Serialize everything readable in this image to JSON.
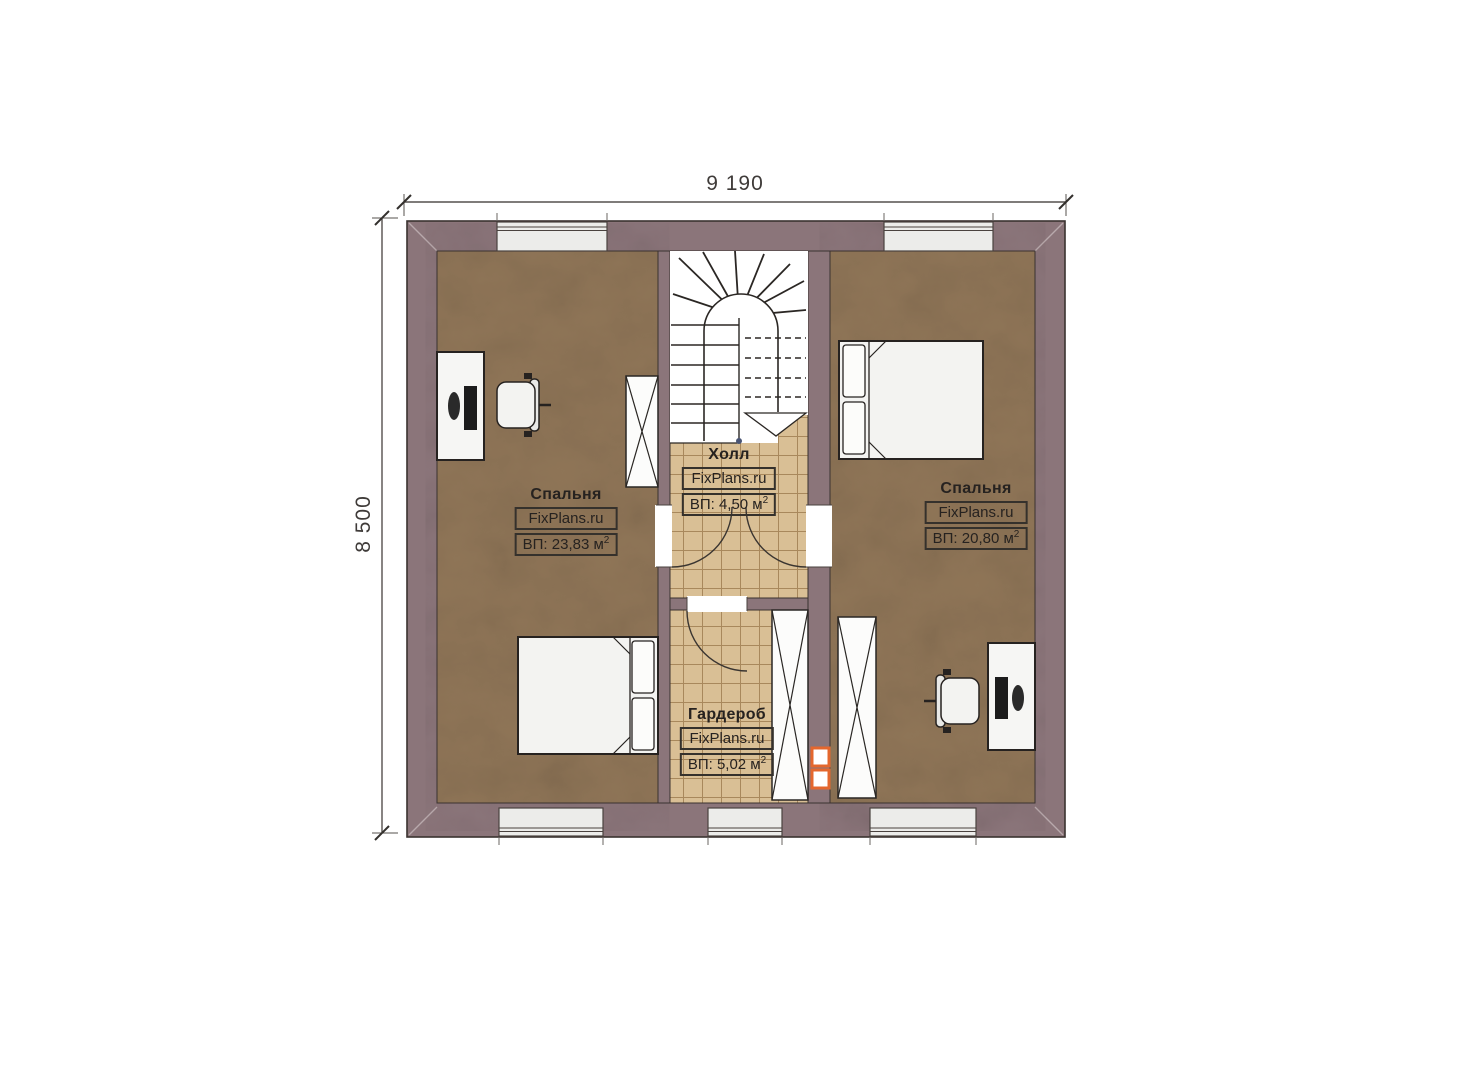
{
  "plan": {
    "width_dim": "9 190",
    "height_dim": "8 500"
  },
  "rooms": {
    "bedroom_left": {
      "name": "Спальня",
      "watermark": "FixPlans.ru",
      "area": "ВП: 23,83 м",
      "area_sup": "2"
    },
    "hall": {
      "name": "Холл",
      "watermark": "FixPlans.ru",
      "area": "ВП: 4,50 м",
      "area_sup": "2"
    },
    "bedroom_right": {
      "name": "Спальня",
      "watermark": "FixPlans.ru",
      "area": "ВП: 20,80 м",
      "area_sup": "2"
    },
    "wardrobe": {
      "name": "Гардероб",
      "watermark": "FixPlans.ru",
      "area": "ВП: 5,02 м",
      "area_sup": "2"
    }
  },
  "colors": {
    "wall": "#8b757a",
    "floor": "#8f7557",
    "tile": "#d9bf95",
    "tile_grid": "#a8885c",
    "accent_vent": "#e4672e",
    "line": "#2b2724",
    "window": "#ececea"
  }
}
